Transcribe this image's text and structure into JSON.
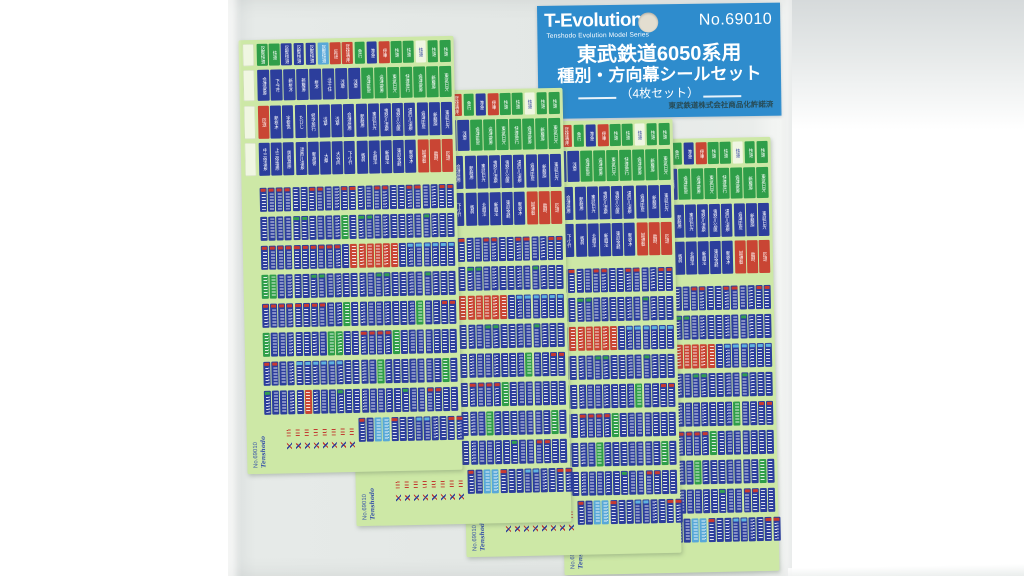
{
  "header_card": {
    "brand": "T-Evolution",
    "tagline": "Tenshodo Evolution Model Series",
    "model_no": "No.69010",
    "title_line1": "東武鉄道6050系用",
    "title_line2": "種別・方向幕シールセット",
    "subtitle": "（4枚セット）",
    "license": "東武鉄道株式会社商品化許諾済",
    "bg_color": "#2e8ccd",
    "text_color": "#ffffff",
    "license_color": "#274b55"
  },
  "sheet": {
    "footer_code": "No.69010",
    "footer_brand": "Tenshodo",
    "bg_color": "#cde8a6",
    "palette": {
      "B": "#2c3e9c",
      "G": "#2f9e49",
      "R": "#c94534",
      "C": "#58a8d8",
      "W": "#f0f6e2"
    },
    "cap_palette": {
      "R": "#c93a30",
      "G": "#33a050",
      "C": "#5fb2e0"
    },
    "count": 4,
    "size": {
      "w": 215,
      "h": 434
    },
    "positions": [
      {
        "x": 243,
        "y": 38,
        "rot": -1.2,
        "z": 6
      },
      {
        "x": 352,
        "y": 90,
        "rot": -1.2,
        "z": 5
      },
      {
        "x": 462,
        "y": 121,
        "rot": -1.2,
        "z": 4
      },
      {
        "x": 560,
        "y": 139,
        "rot": -1.2,
        "z": 3
      }
    ],
    "blank_column": {
      "x": 4,
      "w": 11,
      "ys": [
        4,
        30,
        66,
        103
      ],
      "hs": [
        22,
        31,
        33,
        33
      ]
    },
    "rows": [
      {
        "y": 4,
        "h": 22,
        "x": 18,
        "w": 10.5,
        "g": 1.7,
        "s": [
          "G",
          "G",
          "B",
          "B",
          "B",
          "C",
          "R",
          "R",
          "G",
          "B",
          "R",
          "G",
          "G",
          "W",
          "G",
          "G"
        ],
        "t": [
          "区間快速",
          "快速",
          "区間快速",
          "区間快速",
          "区間快速",
          "区間快速",
          "回送",
          "団体専用",
          "急行",
          "準急",
          "停車",
          "快速",
          "快速",
          "快速",
          "快速",
          "快速"
        ]
      },
      {
        "y": 30,
        "h": 31,
        "x": 18,
        "w": 12,
        "g": 1,
        "s": [
          "B",
          "B",
          "B",
          "B",
          "B",
          "B",
          "B",
          "B",
          "G",
          "G",
          "G",
          "G",
          "G",
          "G",
          "G"
        ],
        "t": [
          "会津高原",
          "下今市",
          "新栃木",
          "新藤原",
          "栃木",
          "北千住",
          "浅草",
          "浅草",
          "会津田島",
          "会津高原",
          "東武日光",
          "快速急行",
          "会津高原",
          "新藤原",
          "東武日光"
        ]
      },
      {
        "y": 66,
        "h": 33,
        "x": 18,
        "w": 11,
        "g": 1.2,
        "s": [
          "R",
          "B",
          "B",
          "B",
          "B",
          "B",
          "B",
          "B",
          "B",
          "B",
          "B",
          "B",
          "B",
          "B",
          "B",
          "B"
        ],
        "t": [
          "回送",
          "新栃木",
          "宇都宮",
          "たびじ",
          "修学旅行",
          "浅草",
          "浅草",
          "会津高原",
          "新藤原",
          "東武日光",
          "鬼怒川温泉",
          "鬼怒川公園",
          "湯西川温泉",
          "会津田島",
          "新藤原",
          "東武日光"
        ]
      },
      {
        "y": 103,
        "h": 33,
        "x": 18,
        "w": 11,
        "g": 1.2,
        "s": [
          "B",
          "B",
          "B",
          "B",
          "B",
          "B",
          "B",
          "B",
          "B",
          "B",
          "B",
          "B",
          "B",
          "R",
          "R",
          "R"
        ],
        "t": [
          "中三依温泉",
          "上三依塩原",
          "男鹿高原",
          "湯西川温泉",
          "新高徳",
          "大桑",
          "大谷向",
          "下小代",
          "板荷",
          "北鹿沼",
          "新鹿沼",
          "東武金崎",
          "新栃木",
          "試運転",
          "臨時",
          "回送"
        ]
      },
      {
        "y": 148,
        "h": 24,
        "x": 18,
        "w": 7,
        "g": 1.13,
        "s": [
          "B.R",
          "B.R",
          "B.R",
          "B.R",
          "B",
          "B",
          "B.R",
          "B.R",
          "B",
          "B",
          "B.R",
          "B.R",
          "B",
          "B",
          "B.R",
          "B.R",
          "B",
          "B",
          "B.R",
          "B.R",
          "B",
          "B",
          "B.R",
          "B.R"
        ]
      },
      {
        "y": 177,
        "h": 24,
        "x": 18,
        "w": 7,
        "g": 1.13,
        "s": [
          "B",
          "B",
          "B",
          "B",
          "B.G",
          "B.G",
          "B",
          "B",
          "B",
          "B",
          "G",
          "B",
          "B.G",
          "B.G",
          "B",
          "B",
          "B",
          "B",
          "B",
          "B",
          "B.G",
          "B",
          "B",
          "B"
        ]
      },
      {
        "y": 206,
        "h": 24,
        "x": 18,
        "w": 7,
        "g": 1.13,
        "s": [
          "B.R",
          "B.R",
          "B.R",
          "B.R",
          "B.R",
          "B.R",
          "B.R",
          "B.R",
          "B.R",
          "B.R",
          "B",
          "R",
          "R",
          "R",
          "R",
          "R",
          "R",
          "B",
          "B.C",
          "B.C",
          "B.C",
          "B.C",
          "B.C",
          "B.C"
        ]
      },
      {
        "y": 235,
        "h": 24,
        "x": 18,
        "w": 7,
        "g": 1.13,
        "s": [
          "G",
          "G",
          "B",
          "B",
          "B",
          "B",
          "B.G",
          "B.G",
          "B",
          "B",
          "B",
          "B",
          "B",
          "B",
          "B.G",
          "B.G",
          "B",
          "B",
          "B",
          "B",
          "B.G",
          "B",
          "B",
          "B"
        ]
      },
      {
        "y": 264,
        "h": 24,
        "x": 18,
        "w": 7,
        "g": 1.13,
        "s": [
          "B.R",
          "B.R",
          "B.R",
          "B.R",
          "B.R",
          "B.R",
          "B.R",
          "B.R",
          "B",
          "B",
          "G",
          "B",
          "B",
          "B",
          "B",
          "B",
          "B",
          "B",
          "B",
          "G",
          "B",
          "B",
          "B.R",
          "B.R"
        ]
      },
      {
        "y": 293,
        "h": 24,
        "x": 18,
        "w": 7,
        "g": 1.13,
        "s": [
          "G",
          "B",
          "B",
          "B",
          "B",
          "B",
          "B",
          "B",
          "G",
          "G",
          "B",
          "B",
          "B.R",
          "B.R",
          "B.R",
          "B.R",
          "G",
          "B",
          "B",
          "B",
          "B",
          "B",
          "B",
          "B"
        ]
      },
      {
        "y": 322,
        "h": 24,
        "x": 18,
        "w": 7,
        "g": 1.13,
        "s": [
          "B.R",
          "B.R",
          "B",
          "B",
          "B.C",
          "B.C",
          "B.C",
          "B.C",
          "B.C",
          "B.C",
          "B",
          "B",
          "B",
          "B",
          "G",
          "B",
          "B",
          "B",
          "B",
          "B",
          "B",
          "B",
          "G",
          "B"
        ]
      },
      {
        "y": 351,
        "h": 24,
        "x": 18,
        "w": 7,
        "g": 1.13,
        "s": [
          "B.G",
          "B",
          "B",
          "B",
          "B",
          "R",
          "B",
          "B",
          "B",
          "B.G",
          "B",
          "B",
          "B",
          "B",
          "B",
          "B",
          "B",
          "B.G",
          "B",
          "B",
          "B.R",
          "B.R",
          "B",
          "B"
        ]
      },
      {
        "y": 380,
        "h": 24,
        "x": 112,
        "w": 7,
        "g": 1.13,
        "s": [
          "B.R",
          "B",
          "C",
          "C",
          "B.R",
          "B",
          "B",
          "B.C",
          "B.C",
          "B",
          "B",
          "B.R",
          "B.R"
        ]
      }
    ],
    "footer": {
      "text_x": 6,
      "text_y": 386,
      "marks_x": 40,
      "marks_y1": 390,
      "marks_y2": 403,
      "marks_count": 8,
      "marks_gap": 9
    }
  },
  "background": {
    "page": "#ffffff",
    "bag": "#e3e7e5",
    "top_right": "#d6dadb"
  }
}
